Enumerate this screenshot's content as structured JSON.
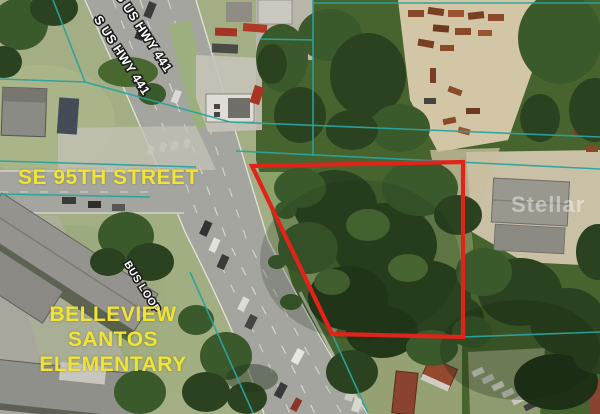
{
  "window": {
    "type": "aerial-parcel-map-photo",
    "width": 600,
    "height": 414
  },
  "map_labels": {
    "street_name": "SE 95TH STREET",
    "school_name_line1": "BELLEVIEW SANTOS",
    "school_name_line2": "ELEMENTARY",
    "highway_label_1": "S US HWY 441",
    "highway_label_2": "S US HWY 441",
    "bus_loop_label": "BUS LOOP",
    "watermark": "Stellar"
  },
  "annotations": {
    "parcel_outline": {
      "color": "#e2231a",
      "stroke_width": 4.2,
      "points": [
        [
          252,
          166
        ],
        [
          463,
          162
        ],
        [
          463,
          337
        ],
        [
          332,
          334
        ]
      ]
    },
    "boundary_lines": {
      "color": "#2ba49e",
      "stroke_width": 1.6,
      "segments": [
        [
          0,
          161,
          196,
          167
        ],
        [
          0,
          194,
          150,
          197
        ],
        [
          53,
          0,
          85,
          82
        ],
        [
          0,
          79,
          85,
          82
        ],
        [
          85,
          82,
          230,
          122
        ],
        [
          230,
          122,
          600,
          137
        ],
        [
          236,
          151,
          600,
          169
        ],
        [
          313,
          0,
          313,
          156
        ],
        [
          260,
          39,
          313,
          40
        ],
        [
          313,
          3,
          600,
          3
        ],
        [
          463,
          337,
          600,
          332
        ],
        [
          190,
          272,
          253,
          413
        ],
        [
          332,
          334,
          368,
          413
        ]
      ]
    },
    "label_colors": {
      "street_text": "#f2e434",
      "road_text": "#ffffff",
      "road_text_outline": "#1a1a1a",
      "watermark_text": "rgba(255,255,255,0.42)"
    }
  }
}
